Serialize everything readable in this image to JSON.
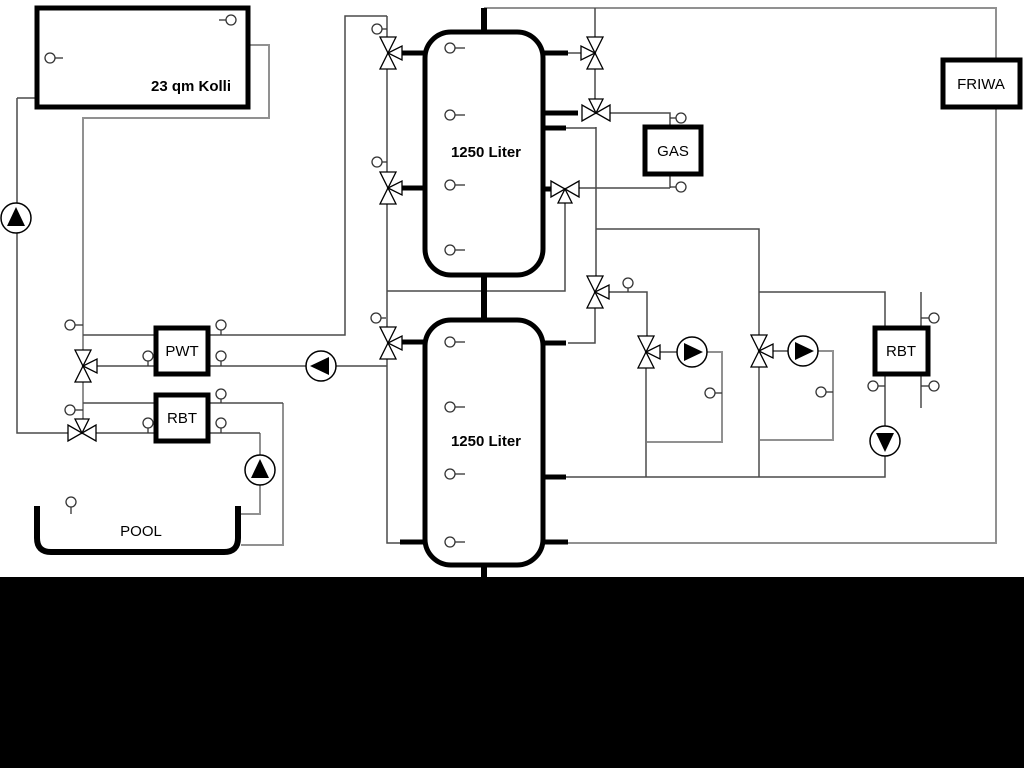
{
  "labels": {
    "collector": "23 qm Kolli",
    "tank_top": "1250 Liter",
    "tank_bottom": "1250 Liter",
    "gas": "GAS",
    "friwa": "FRIWA",
    "pwt": "PWT",
    "rbt_left": "RBT",
    "rbt_right": "RBT",
    "pool": "POOL"
  },
  "colors": {
    "background": "#ffffff",
    "line_dark": "#4a4a4a",
    "line_gray": "#919191",
    "symbol_black": "#000000",
    "bottom_band": "#000000"
  }
}
